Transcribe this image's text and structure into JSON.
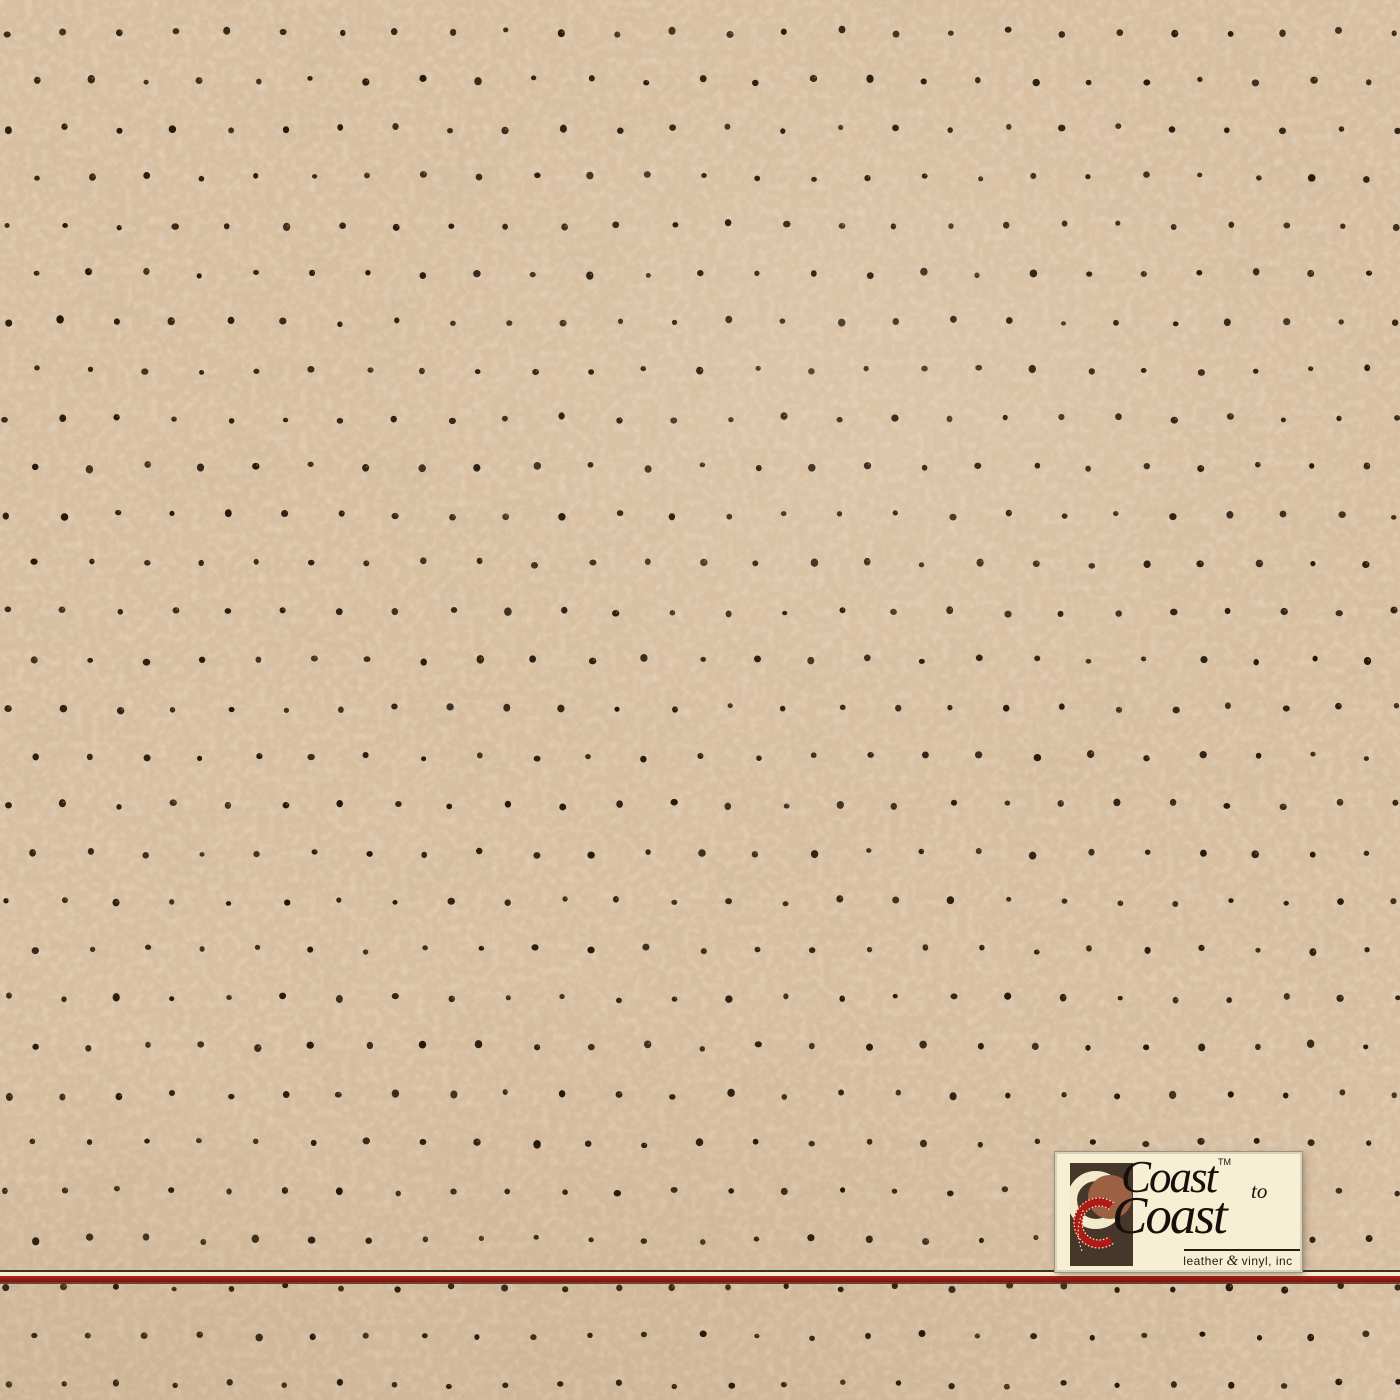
{
  "image": {
    "width": 1400,
    "height": 1400,
    "kind": "tan perforated leather swatch photo"
  },
  "texture": {
    "base_color": "#d8bfa2",
    "speckle_light_color": "#f0ddc0",
    "mottle_dark_color": "#8d6f4a",
    "perforation": {
      "dot_color": "#231708",
      "dot_highlight": "#9c7a52",
      "dot_radius": 3.1,
      "origin_x": 7,
      "origin_y": 32,
      "spacing_x": 55.56,
      "spacing_y": 48.3,
      "row_offset_x": 27.78,
      "rows": 29,
      "cols_even": 26,
      "cols_odd": 25,
      "jitter": 2.6,
      "seed": 20240915
    }
  },
  "stripe": {
    "top_edge_color": "#43301f",
    "cream_color": "#f5ecd1",
    "red_color": "#9e1a12",
    "shadow_color": "#55301c"
  },
  "logo": {
    "word_top": "Coast",
    "trademark": "TM",
    "connector": "to",
    "word_bottom": "Coast",
    "tagline": {
      "leather": "leather",
      "ampersand": "&",
      "vinyl": "vinyl, inc"
    },
    "background_color": "#f7efd4",
    "emblem": {
      "panel_color": "#46372a",
      "cream_ring_color": "#f3e9cb",
      "sienna_circle_color": "#9c6143",
      "red_ring_color": "#ae1c17",
      "stitch_color": "#f6eed6"
    }
  }
}
